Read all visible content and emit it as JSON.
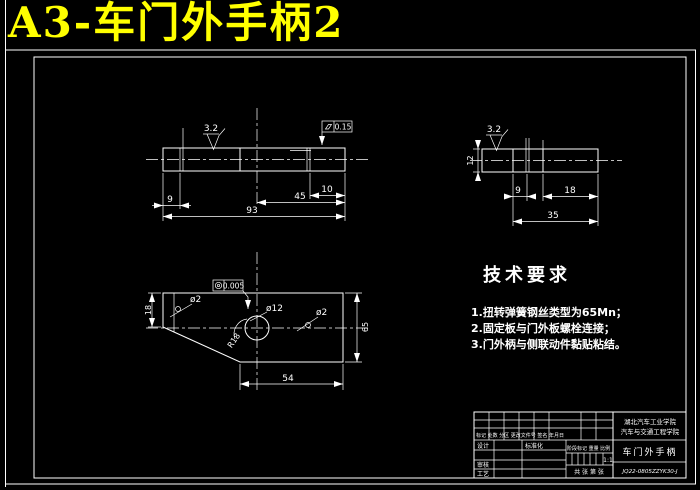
{
  "window": {
    "title": "A3-车门外手柄2"
  },
  "colors": {
    "background": "#000000",
    "lines": "#ffffff",
    "title_text": "#ffff00"
  },
  "views": {
    "front": {
      "roughness": "3.2",
      "tolerance": {
        "symbol": "flatness",
        "value": "0.15"
      },
      "dims": {
        "w9": "9",
        "w10": "10",
        "w45": "45",
        "w93": "93"
      }
    },
    "side": {
      "roughness": "3.2",
      "dims": {
        "h12": "12",
        "w9": "9",
        "w18": "18",
        "w35": "35"
      }
    },
    "profile": {
      "tolerance": {
        "symbol": "concentricity",
        "value": "0.005"
      },
      "labels": {
        "phi2_left": "ø2",
        "phi12": "ø12",
        "phi2_right": "ø2",
        "radius": "R18"
      },
      "dims": {
        "h18": "18",
        "w54": "54",
        "h65": "65"
      }
    }
  },
  "tech_requirements": {
    "heading": "技术要求",
    "items": [
      "1.扭转弹簧钢丝类型为65Mn；",
      "2.固定板与门外板螺栓连接；",
      "3.门外柄与侧联动件黏贴粘结。"
    ]
  },
  "title_block": {
    "revision_header": "标记 处数 分区 更改文件号 签名 年月日",
    "design": "设计",
    "standardization": "标准化",
    "check": "审核",
    "process": "工艺",
    "stage_header": "阶段标记 重量 比例",
    "scale": "1:1",
    "sheet": "共 张 第 张",
    "institution_line1": "湖北汽车工业学院",
    "institution_line2": "汽车与交通工程学院",
    "part_name": "车门外手柄",
    "drawing_no": "JQ22-0805ZZYK30-J"
  }
}
